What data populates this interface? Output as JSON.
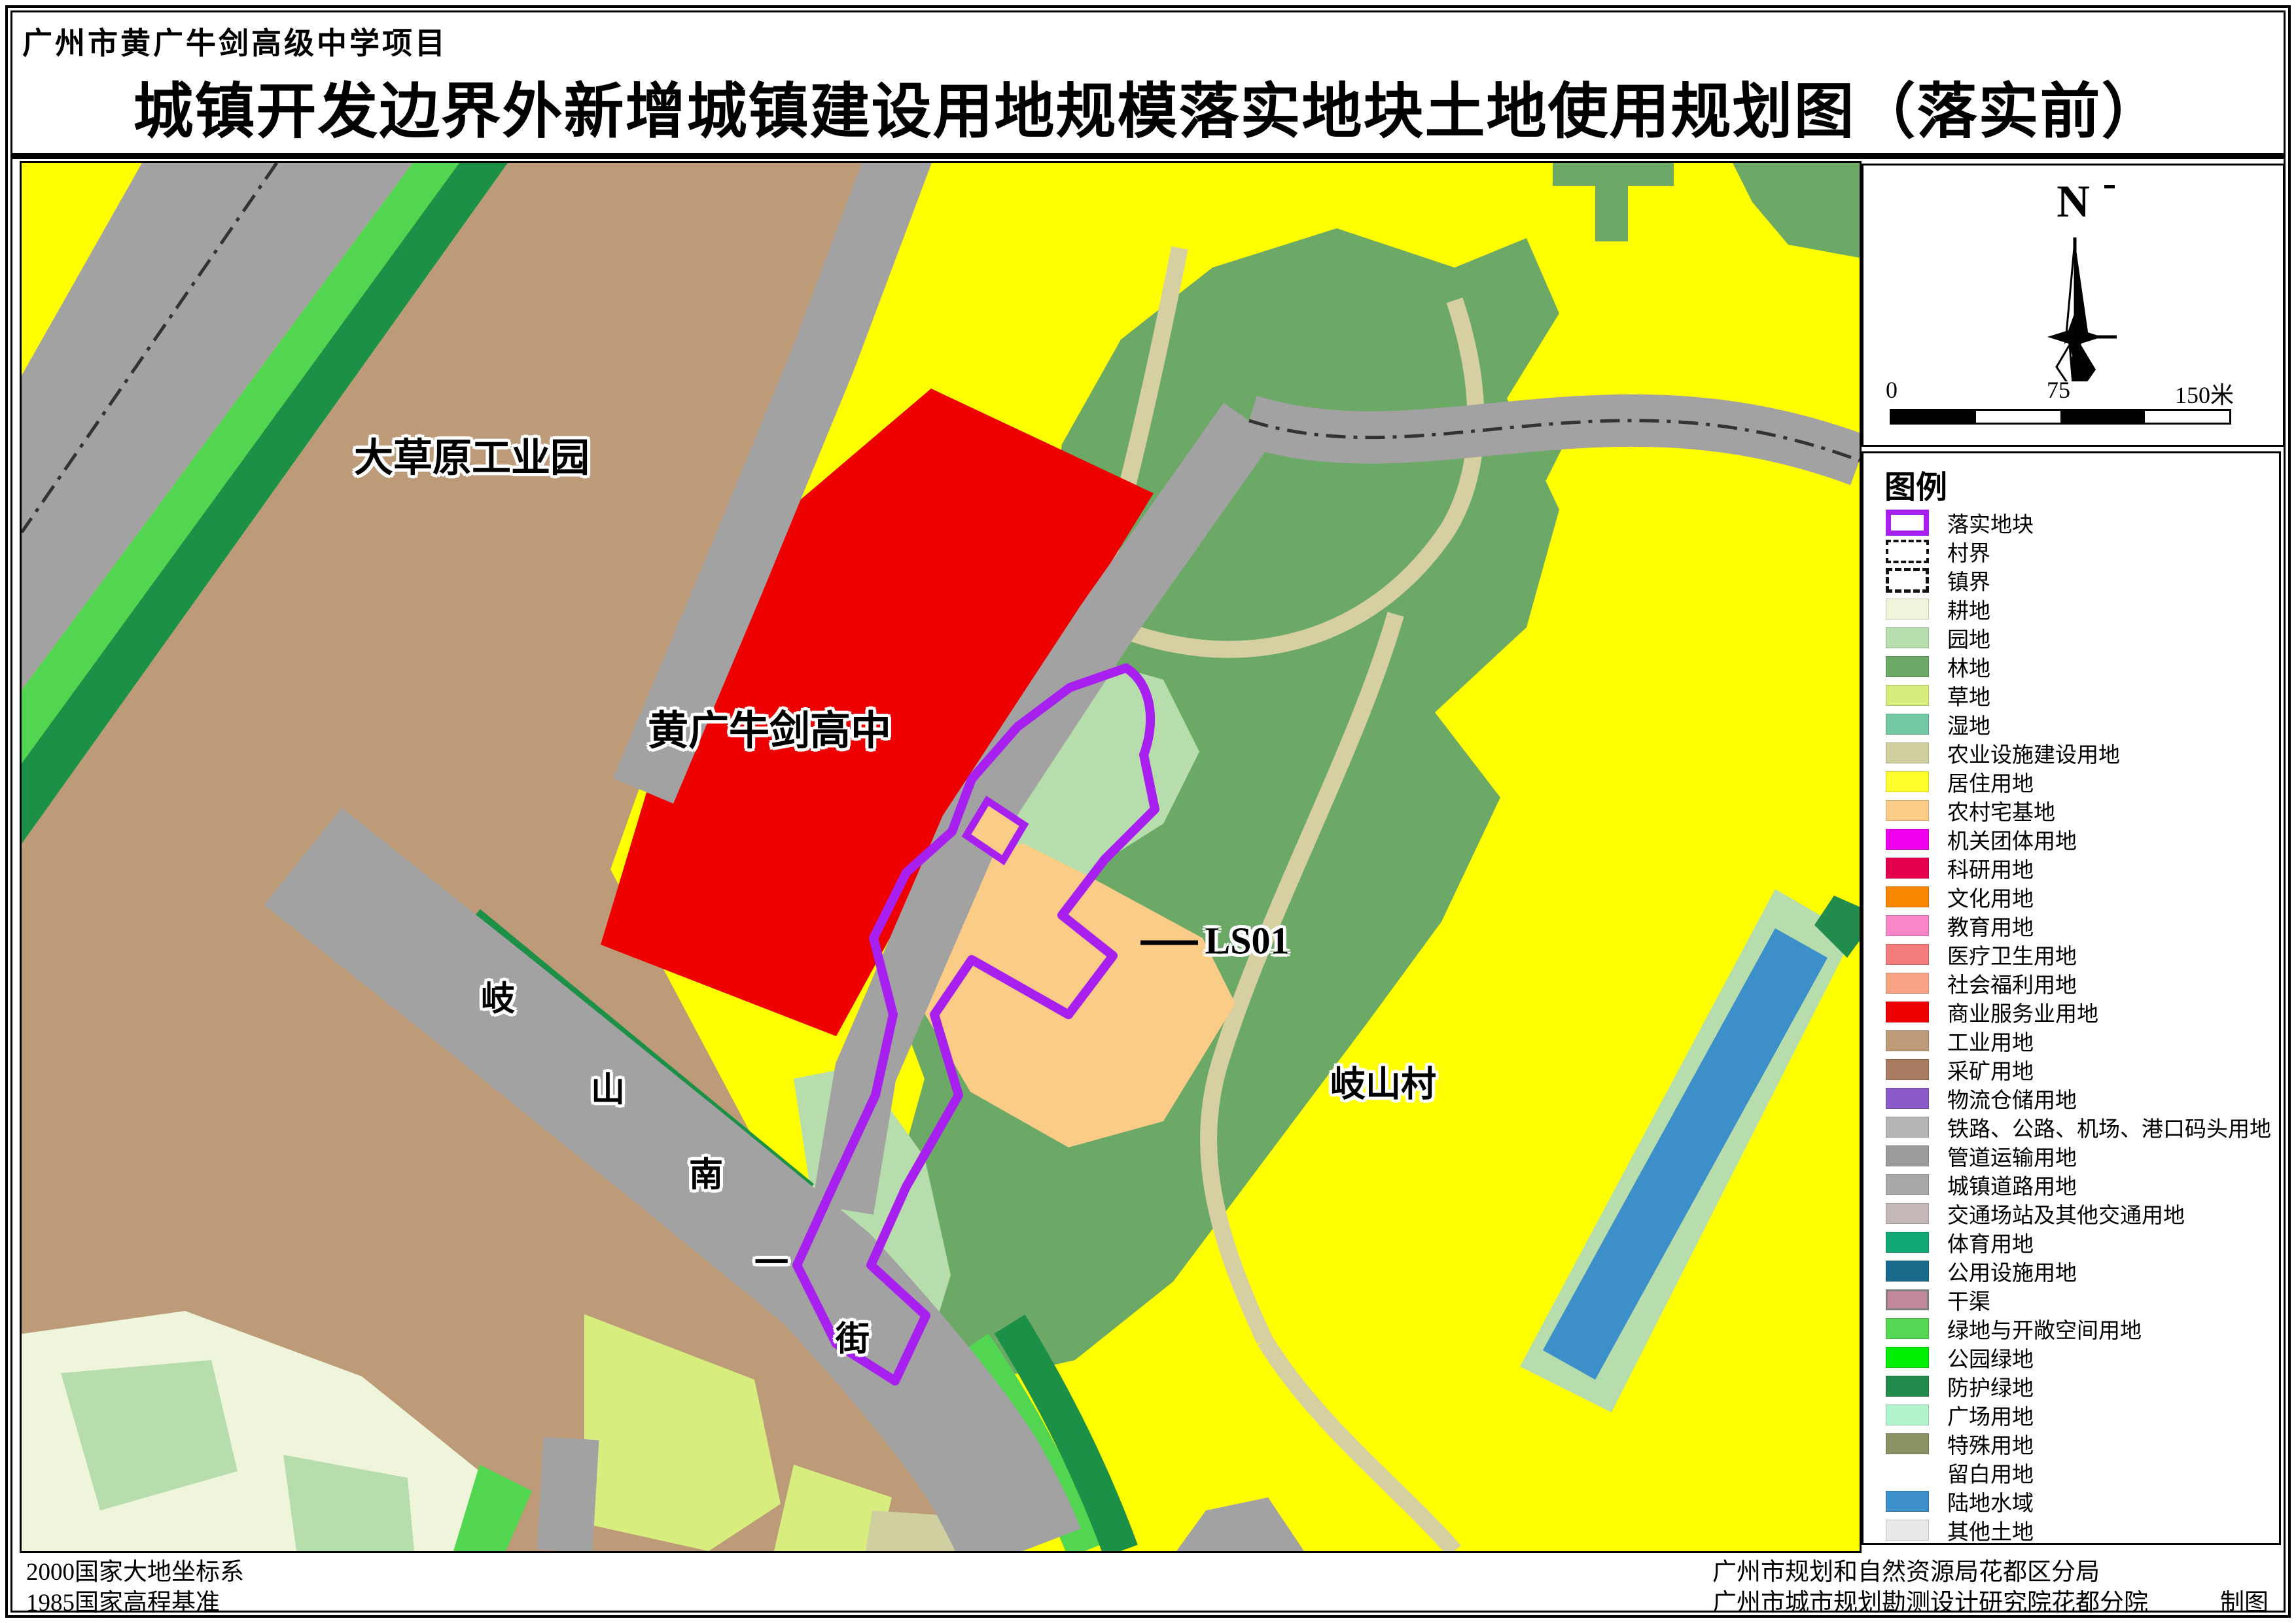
{
  "title": {
    "project": "广州市黄广牛剑高级中学项目",
    "main": "城镇开发边界外新增城镇建设用地规模落实地块土地使用规划图（落实前）"
  },
  "map": {
    "labels": {
      "industrial_park": "大草原工业园",
      "school": "黄广牛剑高中",
      "village": "岐山村",
      "plot_code": "LS01",
      "street": "岐山南一街",
      "street_chars": [
        "岐",
        "山",
        "南",
        "一",
        "街"
      ]
    }
  },
  "north_panel": {
    "north_label": "N",
    "scale_ticks": [
      "0",
      "75",
      "150米"
    ]
  },
  "legend": {
    "header": "图例",
    "items": [
      {
        "label": "落实地块",
        "swatch": "outline",
        "color": "#A820F0"
      },
      {
        "label": "村界",
        "swatch": "dashdot",
        "color": "#111111"
      },
      {
        "label": "镇界",
        "swatch": "dashed",
        "color": "#111111"
      },
      {
        "label": "耕地",
        "swatch": "fill",
        "color": "#EFF5DA"
      },
      {
        "label": "园地",
        "swatch": "fill",
        "color": "#B7DDAD"
      },
      {
        "label": "林地",
        "swatch": "fill",
        "color": "#6CA967"
      },
      {
        "label": "草地",
        "swatch": "fill",
        "color": "#D7EE7F"
      },
      {
        "label": "湿地",
        "swatch": "fill",
        "color": "#72C9A4"
      },
      {
        "label": "农业设施建设用地",
        "swatch": "fill",
        "color": "#CFCFA0"
      },
      {
        "label": "居住用地",
        "swatch": "fill",
        "color": "#FFFF2E"
      },
      {
        "label": "农村宅基地",
        "swatch": "fill",
        "color": "#FACC87"
      },
      {
        "label": "机关团体用地",
        "swatch": "fill",
        "color": "#EE00EE"
      },
      {
        "label": "科研用地",
        "swatch": "fill",
        "color": "#E2004F"
      },
      {
        "label": "文化用地",
        "swatch": "fill",
        "color": "#F98800"
      },
      {
        "label": "教育用地",
        "swatch": "fill",
        "color": "#F787C9"
      },
      {
        "label": "医疗卫生用地",
        "swatch": "fill",
        "color": "#F37C7C"
      },
      {
        "label": "社会福利用地",
        "swatch": "fill",
        "color": "#F8A485"
      },
      {
        "label": "商业服务业用地",
        "swatch": "fill",
        "color": "#EE0000"
      },
      {
        "label": "工业用地",
        "swatch": "fill",
        "color": "#BD9B79"
      },
      {
        "label": "采矿用地",
        "swatch": "fill",
        "color": "#A97B60"
      },
      {
        "label": "物流仓储用地",
        "swatch": "fill",
        "color": "#8B5BCB"
      },
      {
        "label": "铁路、公路、机场、港口码头用地",
        "swatch": "fill",
        "color": "#B5B5B5"
      },
      {
        "label": "管道运输用地",
        "swatch": "fill",
        "color": "#9B9B9B"
      },
      {
        "label": "城镇道路用地",
        "swatch": "fill",
        "color": "#A9A9A9"
      },
      {
        "label": "交通场站及其他交通用地",
        "swatch": "fill",
        "color": "#C4B8B8"
      },
      {
        "label": "体育用地",
        "swatch": "fill",
        "color": "#13A878"
      },
      {
        "label": "公用设施用地",
        "swatch": "fill",
        "color": "#1A6A8C"
      },
      {
        "label": "干渠",
        "swatch": "fill-border",
        "color": "#C2879B"
      },
      {
        "label": "绿地与开敞空间用地",
        "swatch": "fill",
        "color": "#55D655"
      },
      {
        "label": "公园绿地",
        "swatch": "fill",
        "color": "#00EE00"
      },
      {
        "label": "防护绿地",
        "swatch": "fill",
        "color": "#218C4B"
      },
      {
        "label": "广场用地",
        "swatch": "fill",
        "color": "#B2F5CD"
      },
      {
        "label": "特殊用地",
        "swatch": "fill",
        "color": "#8C9163"
      },
      {
        "label": "留白用地",
        "swatch": "blank",
        "color": "#FFFFFF"
      },
      {
        "label": "陆地水域",
        "swatch": "fill",
        "color": "#3D8FC9"
      },
      {
        "label": "其他土地",
        "swatch": "fill",
        "color": "#E9E9E9"
      }
    ]
  },
  "footer": {
    "left_lines": [
      "2000国家大地坐标系",
      "1985国家高程基准"
    ],
    "right_lines": [
      "广州市规划和自然资源局花都区分局",
      "广州市城市规划勘测设计研究院花都分院"
    ],
    "credit": "制图"
  },
  "colors": {
    "residential": "#FFFF00",
    "industrial": "#BD9B79",
    "commercial": "#EE0000",
    "forest": "#6CA967",
    "orchard": "#B7DDAD",
    "road": "#A2A2A2",
    "green_open": "#52D652",
    "protect_green": "#1D9048",
    "rural_housing": "#FACC87",
    "water": "#3D8FC9",
    "plot_outline": "#A820F0",
    "path": "#D6CFA2",
    "farmland": "#EFF5DA",
    "grass": "#D7EE7F"
  }
}
